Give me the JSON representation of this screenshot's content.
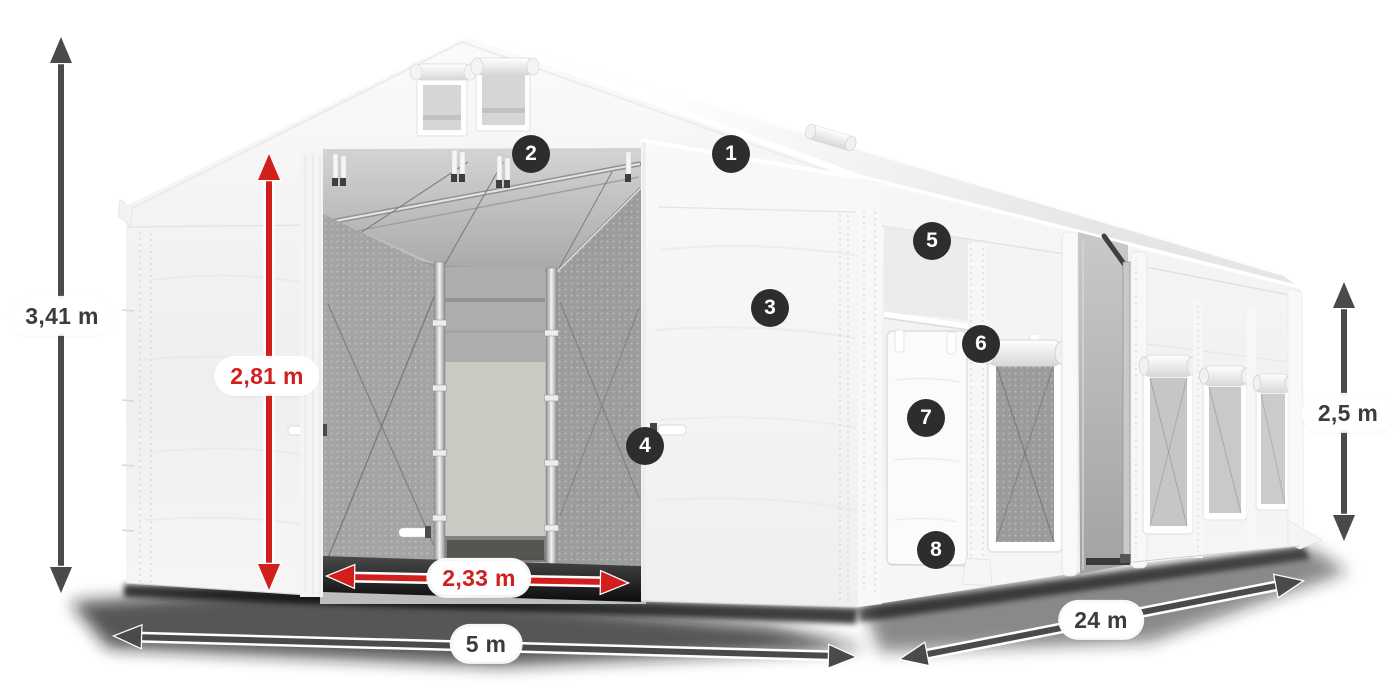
{
  "diagram": {
    "type": "tent-product-dimension-diagram",
    "colors": {
      "dimension_red": "#d01f1c",
      "dimension_dark": "#4a4a4a",
      "badge_background": "#2d2d2d",
      "badge_text": "#ffffff",
      "tent_white": "#f6f6f6",
      "background": "#ffffff"
    },
    "dimensions": {
      "total_height": {
        "label": "3,41 m",
        "style": "dark"
      },
      "entrance_height": {
        "label": "2,81 m",
        "style": "red"
      },
      "entrance_width": {
        "label": "2,33 m",
        "style": "red"
      },
      "width": {
        "label": "5 m",
        "style": "dark"
      },
      "length": {
        "label": "24 m",
        "style": "dark"
      },
      "side_height": {
        "label": "2,5 m",
        "style": "dark"
      }
    },
    "callouts": [
      {
        "number": "1"
      },
      {
        "number": "2"
      },
      {
        "number": "3"
      },
      {
        "number": "4"
      },
      {
        "number": "5"
      },
      {
        "number": "6"
      },
      {
        "number": "7"
      },
      {
        "number": "8"
      }
    ]
  }
}
